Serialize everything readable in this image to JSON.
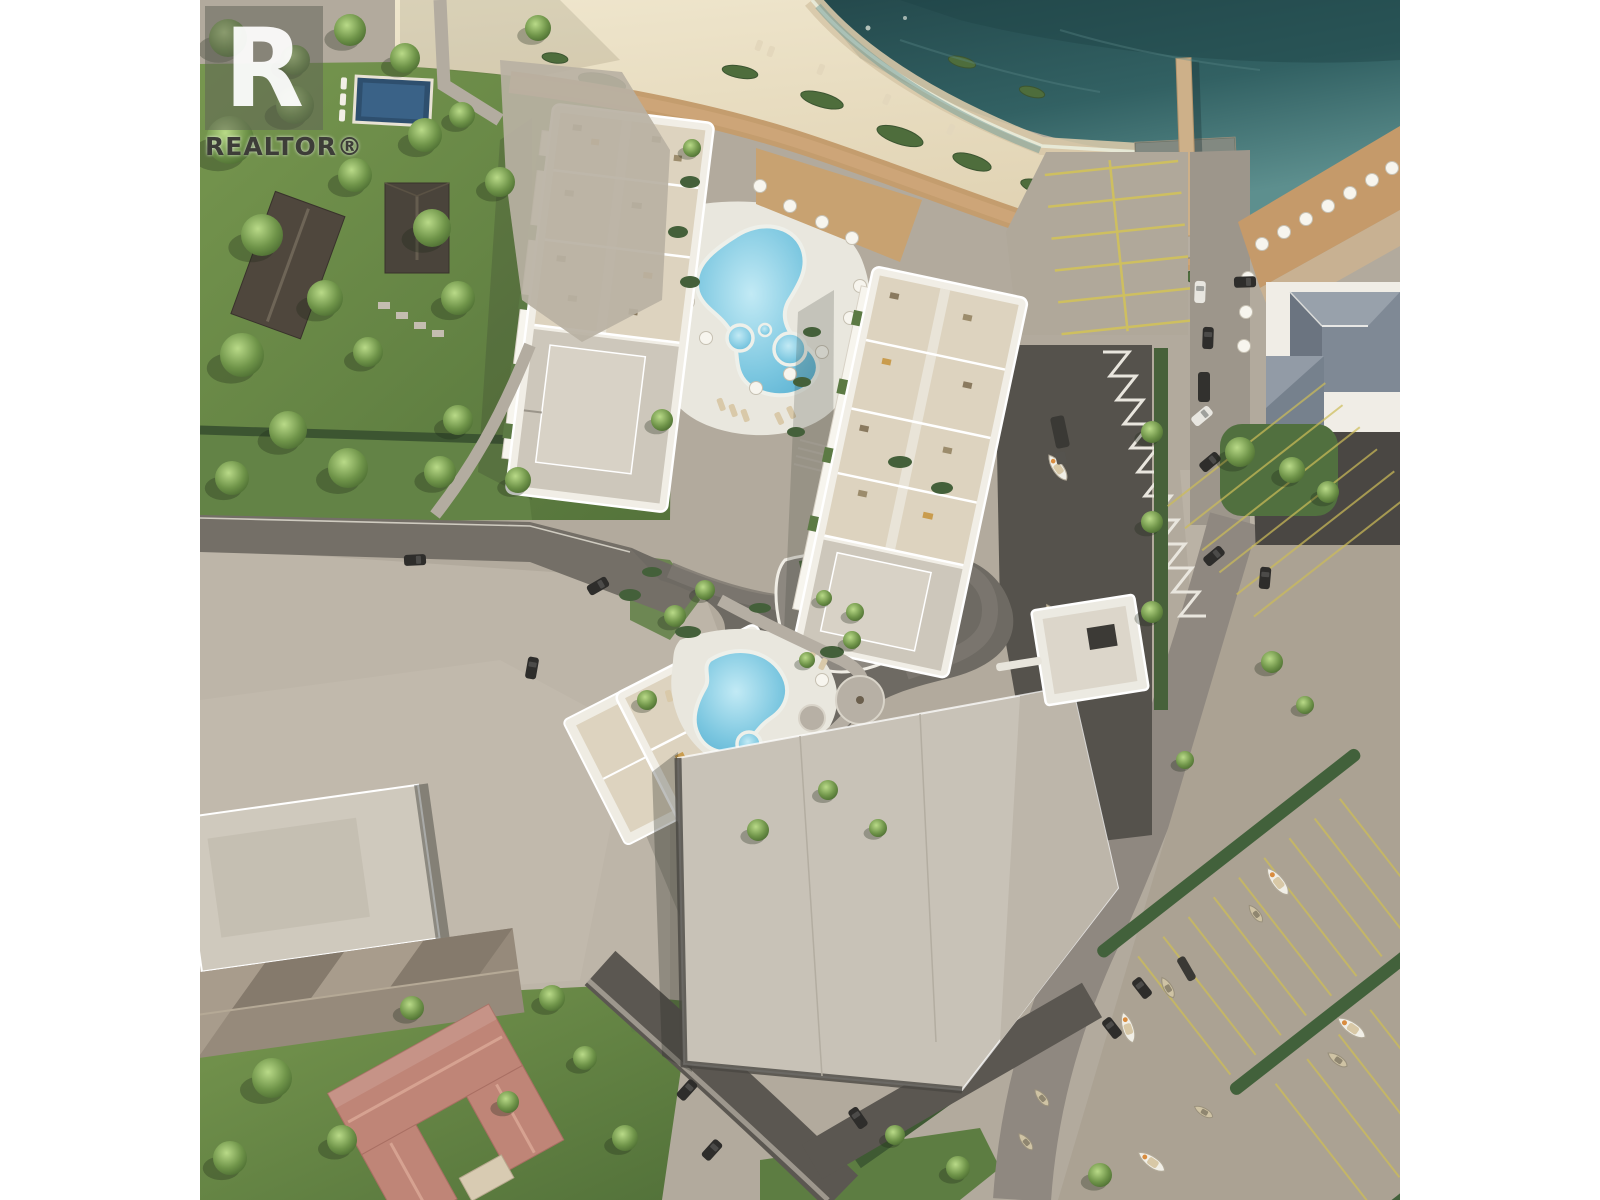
{
  "watermark": {
    "logo_letter": "R",
    "label": "REALTOR®"
  },
  "scene": {
    "type": "aerial-architectural-rendering",
    "subject": "beachfront condominium development with three residential towers, rooftop terraces, two resort pools with hot tubs, sandy beach, lake, pier, boat launch ramp, marina boat yard, restaurant and neighbouring houses",
    "palette": {
      "water": "#2c5558",
      "water_shallow": "#5d8f8e",
      "sand": "#e9dec4",
      "grass": "#68874a",
      "hedge": "#42613b",
      "asphalt": "#5b5751",
      "concrete": "#b5ada0",
      "building_wall": "#f1eee6",
      "terrace": "#ddd3bf",
      "flat_roof": "#c8c2b7",
      "pool": "#6fc0dd",
      "boardwalk_wood": "#c49d6e",
      "red_roof": "#bf8577",
      "restaurant_roof": "#7f8995",
      "parking_line_yellow": "#d2c25a"
    },
    "features": [
      "lake-water",
      "sandy-beach",
      "shoreline-foam",
      "wooden-pier",
      "boat-ramp",
      "beach-boardwalk",
      "main-pool",
      "hot-tubs",
      "courtyard-pool",
      "tower-a",
      "tower-b",
      "tower-c",
      "low-rise-building",
      "restaurant-building",
      "restaurant-deck-umbrellas",
      "beach-parking",
      "marina-boat-yard",
      "boats",
      "roads",
      "cars",
      "neighbour-houses",
      "neighbour-pool",
      "trees",
      "lawns",
      "hedges"
    ]
  }
}
